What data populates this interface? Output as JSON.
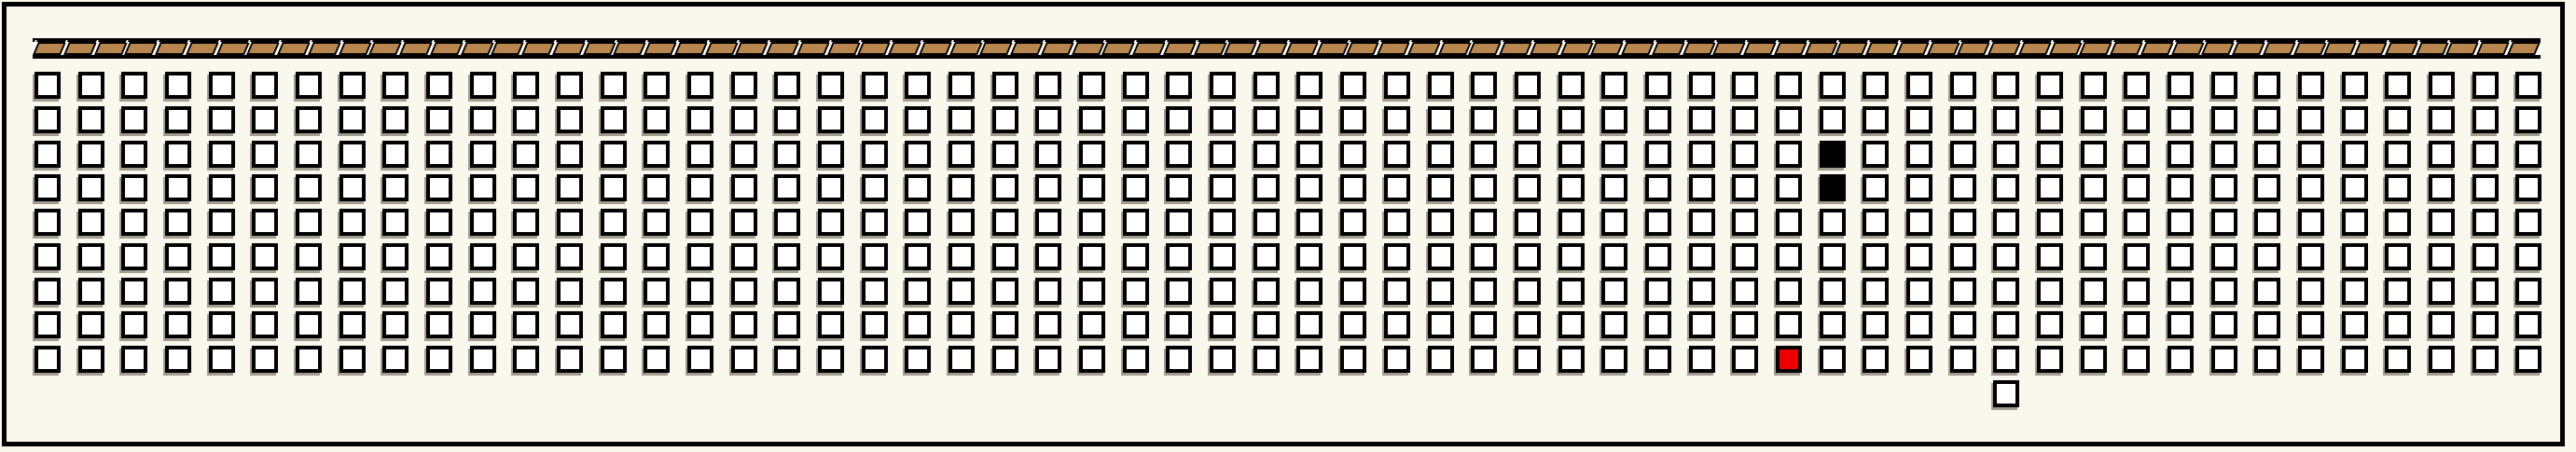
{
  "window": {
    "kind": "checkbox-grid-panel",
    "background": "#faf8ec",
    "border_color": "#000000"
  },
  "ribbon": {
    "segment_count": 82,
    "segment_fill": "#b7874f",
    "segment_border": "#000000",
    "band_background": "#ffffff",
    "band_border": "#000000",
    "tick_color": "#ffffff"
  },
  "grid": {
    "rows": 9,
    "columns": 58,
    "cell_fill": "#ffffff",
    "cell_border": "#000000",
    "cell_shadow": "#a29d90",
    "marked_cells": [
      {
        "row": 2,
        "col": 41,
        "fill": "#000000",
        "state": "black"
      },
      {
        "row": 3,
        "col": 41,
        "fill": "#000000",
        "state": "black"
      },
      {
        "row": 8,
        "col": 40,
        "fill": "#ee0000",
        "state": "red"
      }
    ],
    "extra_cells": [
      {
        "row": 9,
        "col": 45,
        "fill": "#ffffff",
        "state": "empty"
      }
    ]
  }
}
